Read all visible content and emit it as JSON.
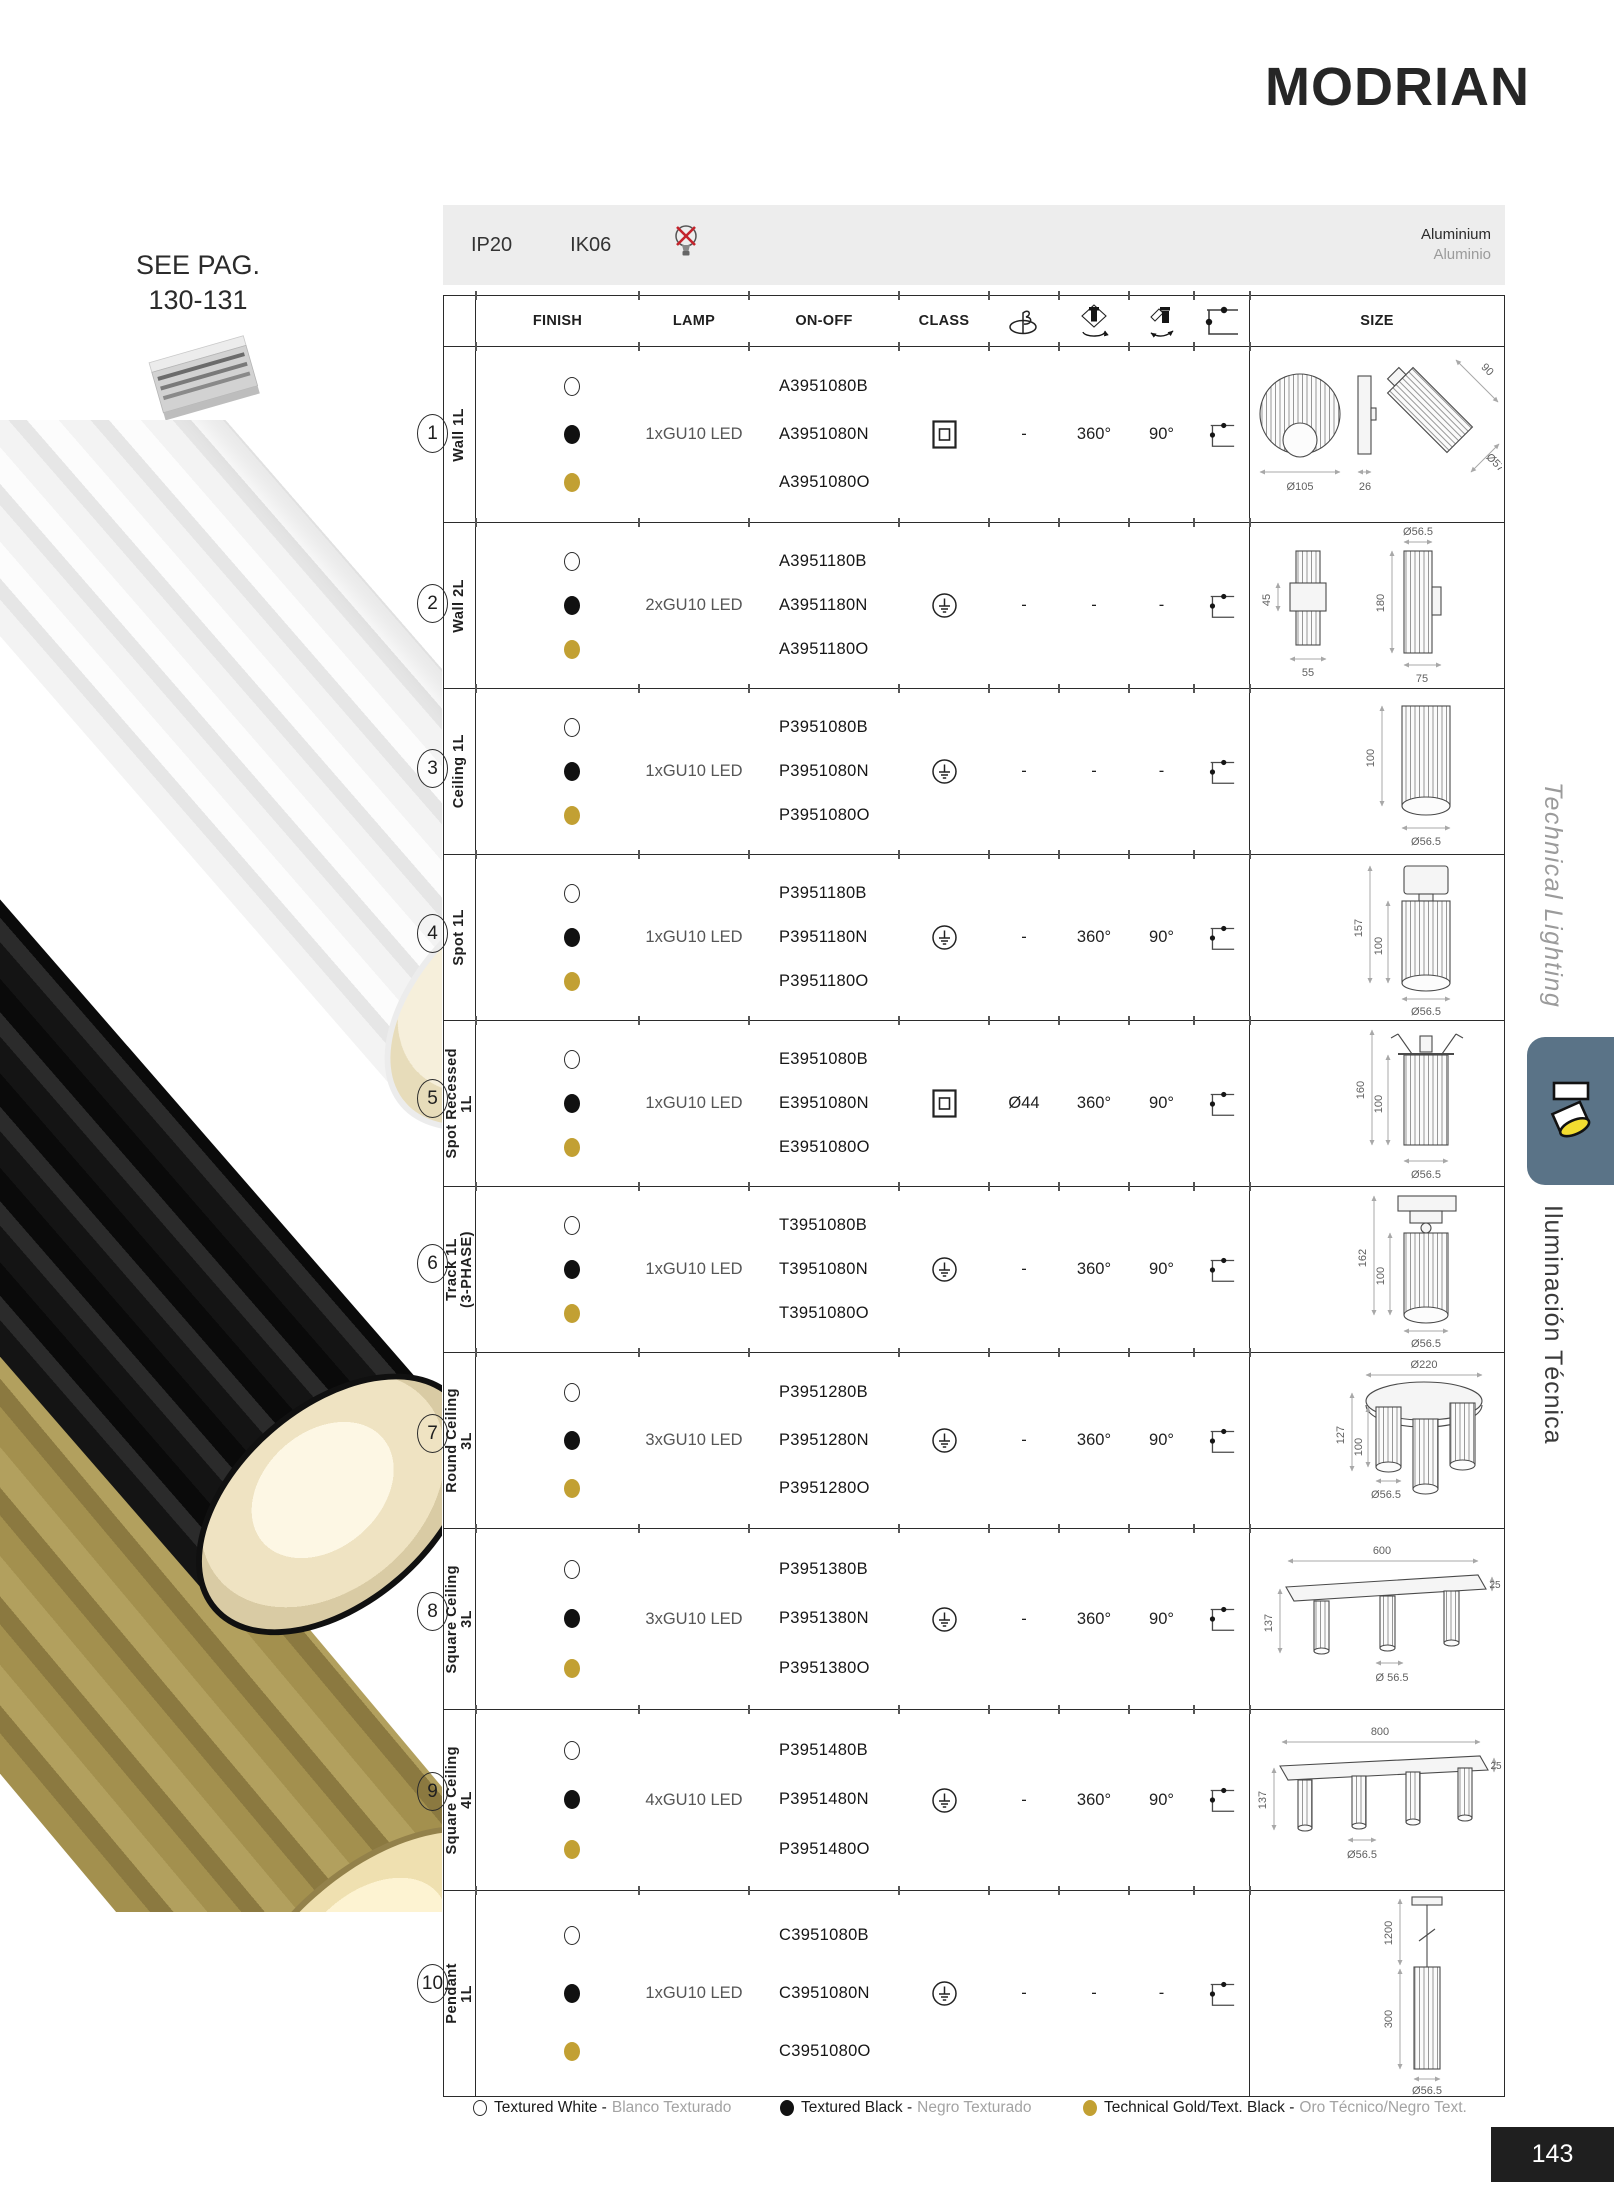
{
  "page": {
    "title": "MODRIAN",
    "page_number": "143",
    "see_page_line1": "SEE PAG.",
    "see_page_line2": "130-131",
    "led_bulbs": {
      "label": "LED BULBS",
      "page": "Pag. 388",
      "icon": "gu10-bulb-icon"
    },
    "track_image": "track-profile-photo",
    "sidebar": {
      "top": "Technical Lighting",
      "bottom": "Iluminación Técnica",
      "tab_icon": "spotlight-icon"
    }
  },
  "info_bar": {
    "ip_rating": "IP20",
    "ik_rating": "IK06",
    "bulb_icon": "bulb-not-included-icon",
    "material_en": "Aluminium",
    "material_es": "Aluminio"
  },
  "table": {
    "headers": {
      "finish": "FINISH",
      "lamp": "LAMP",
      "on_off": "ON-OFF",
      "class": "CLASS",
      "size": "SIZE"
    },
    "header_icons": [
      "cutout-hole-icon",
      "rotation-360-icon",
      "tilt-90-icon",
      "mounting-bracket-icon"
    ],
    "rows": [
      {
        "num": "1",
        "label": "Wall 1L",
        "label2": "",
        "lamp": "1xGU10 LED",
        "codes": [
          "A3951080B",
          "A3951080N",
          "A3951080O"
        ],
        "class": "II",
        "hole": "-",
        "rotation": "360°",
        "tilt": "90°",
        "dims": [
          "Ø105",
          "26",
          "90",
          "Ø57"
        ]
      },
      {
        "num": "2",
        "label": "Wall 2L",
        "label2": "",
        "lamp": "2xGU10 LED",
        "codes": [
          "A3951180B",
          "A3951180N",
          "A3951180O"
        ],
        "class": "I",
        "hole": "-",
        "rotation": "-",
        "tilt": "-",
        "dims": [
          "45",
          "55",
          "Ø56.5",
          "180",
          "75"
        ]
      },
      {
        "num": "3",
        "label": "Ceiling 1L",
        "label2": "",
        "lamp": "1xGU10 LED",
        "codes": [
          "P3951080B",
          "P3951080N",
          "P3951080O"
        ],
        "class": "I",
        "hole": "-",
        "rotation": "-",
        "tilt": "-",
        "dims": [
          "100",
          "Ø56.5"
        ]
      },
      {
        "num": "4",
        "label": "Spot 1L",
        "label2": "",
        "lamp": "1xGU10 LED",
        "codes": [
          "P3951180B",
          "P3951180N",
          "P3951180O"
        ],
        "class": "I",
        "hole": "-",
        "rotation": "360°",
        "tilt": "90°",
        "dims": [
          "157",
          "100",
          "Ø56.5"
        ]
      },
      {
        "num": "5",
        "label": "Spot Recessed",
        "label2": "1L",
        "lamp": "1xGU10 LED",
        "codes": [
          "E3951080B",
          "E3951080N",
          "E3951080O"
        ],
        "class": "II",
        "hole": "Ø44",
        "rotation": "360°",
        "tilt": "90°",
        "dims": [
          "160",
          "100",
          "Ø56.5"
        ]
      },
      {
        "num": "6",
        "label": "Track 1L",
        "label2": "(3-PHASE)",
        "lamp": "1xGU10 LED",
        "codes": [
          "T3951080B",
          "T3951080N",
          "T3951080O"
        ],
        "class": "I",
        "hole": "-",
        "rotation": "360°",
        "tilt": "90°",
        "dims": [
          "162",
          "100",
          "Ø56.5"
        ]
      },
      {
        "num": "7",
        "label": "Round Ceiling",
        "label2": "3L",
        "lamp": "3xGU10 LED",
        "codes": [
          "P3951280B",
          "P3951280N",
          "P3951280O"
        ],
        "class": "I",
        "hole": "-",
        "rotation": "360°",
        "tilt": "90°",
        "dims": [
          "Ø220",
          "127",
          "100",
          "Ø56.5"
        ]
      },
      {
        "num": "8",
        "label": "Square Ceiling",
        "label2": "3L",
        "lamp": "3xGU10 LED",
        "codes": [
          "P3951380B",
          "P3951380N",
          "P3951380O"
        ],
        "class": "I",
        "hole": "-",
        "rotation": "360°",
        "tilt": "90°",
        "dims": [
          "600",
          "25",
          "137",
          "Ø 56.5"
        ]
      },
      {
        "num": "9",
        "label": "Square Ceiling",
        "label2": "4L",
        "lamp": "4xGU10 LED",
        "codes": [
          "P3951480B",
          "P3951480N",
          "P3951480O"
        ],
        "class": "I",
        "hole": "-",
        "rotation": "360°",
        "tilt": "90°",
        "dims": [
          "800",
          "25",
          "137",
          "Ø56.5"
        ]
      },
      {
        "num": "10",
        "label": "Pendant",
        "label2": "1L",
        "lamp": "1xGU10 LED",
        "codes": [
          "C3951080B",
          "C3951080N",
          "C3951080O"
        ],
        "class": "I",
        "hole": "-",
        "rotation": "-",
        "tilt": "-",
        "dims": [
          "1200",
          "300",
          "Ø56.5"
        ]
      }
    ]
  },
  "legend": [
    {
      "color": "white",
      "label_en": "Textured White -",
      "label_es": "Blanco Texturado"
    },
    {
      "color": "black",
      "label_en": "Textured Black -",
      "label_es": "Negro Texturado"
    },
    {
      "color": "gold",
      "label_en": "Technical Gold/Text. Black -",
      "label_es": "Oro Técnico/Negro Text."
    }
  ],
  "colors": {
    "gold": "#c2a033",
    "tab_blue": "#5a7387",
    "no_bulb_red": "#c4232b",
    "page_box": "#1f1f1f"
  }
}
